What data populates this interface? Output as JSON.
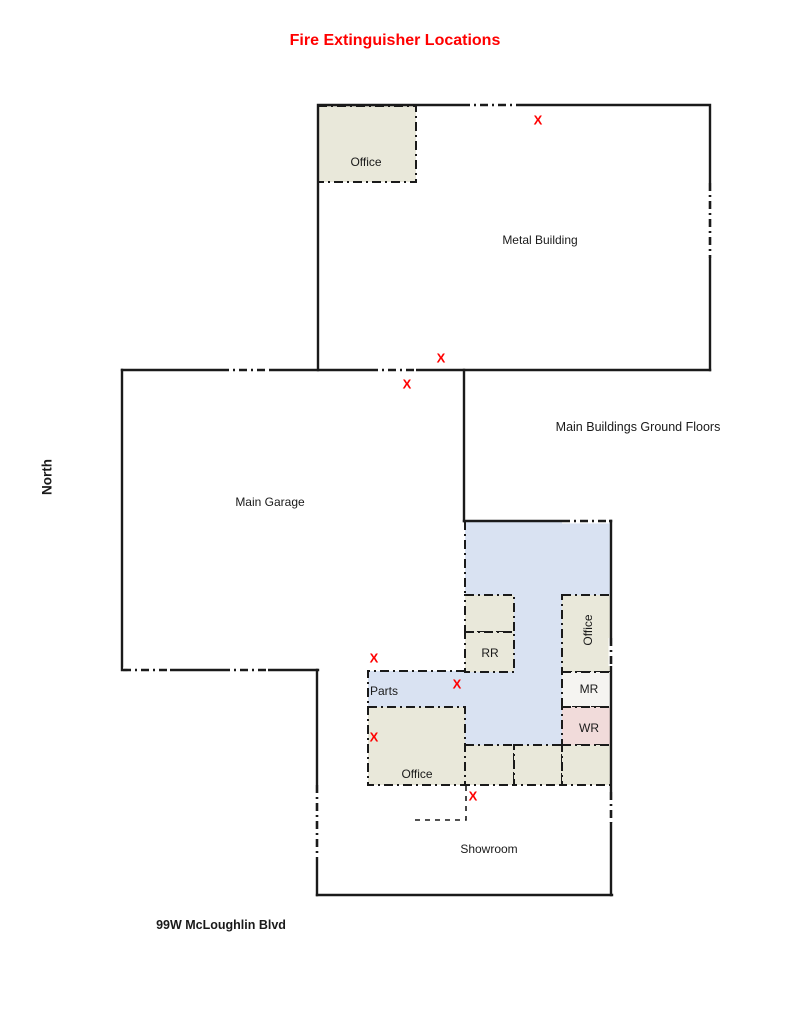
{
  "title": {
    "text": "Fire Extinguisher Locations"
  },
  "colors": {
    "title_red": "#ff0000",
    "mark_red": "#ff0000",
    "wall_black": "#1a1a1a",
    "room_beige": "#e9e8da",
    "area_blue": "#d9e2f2",
    "room_pink": "#f1dbda",
    "room_offwhite": "#f5f4f1"
  },
  "compass": {
    "north_label": "North"
  },
  "address": {
    "street_label": "99W McLoughlin Blvd"
  },
  "buildings": {
    "note": "Main Buildings Ground Floors",
    "metal_building": {
      "name": "Metal Building",
      "office": "Office"
    },
    "main_garage": {
      "name": "Main Garage"
    },
    "showroom": {
      "name": "Showroom"
    },
    "rooms": {
      "rr": "RR",
      "office_east": "Office",
      "mr": "MR",
      "wr": "WR",
      "parts": "Parts",
      "office_lower": "Office"
    }
  },
  "extinguisher": {
    "symbol": "X",
    "color": "#ff0000",
    "locations": [
      {
        "x": 538,
        "y": 120
      },
      {
        "x": 441,
        "y": 358
      },
      {
        "x": 407,
        "y": 384
      },
      {
        "x": 374,
        "y": 658
      },
      {
        "x": 457,
        "y": 684
      },
      {
        "x": 374,
        "y": 737
      },
      {
        "x": 473,
        "y": 796
      }
    ]
  }
}
